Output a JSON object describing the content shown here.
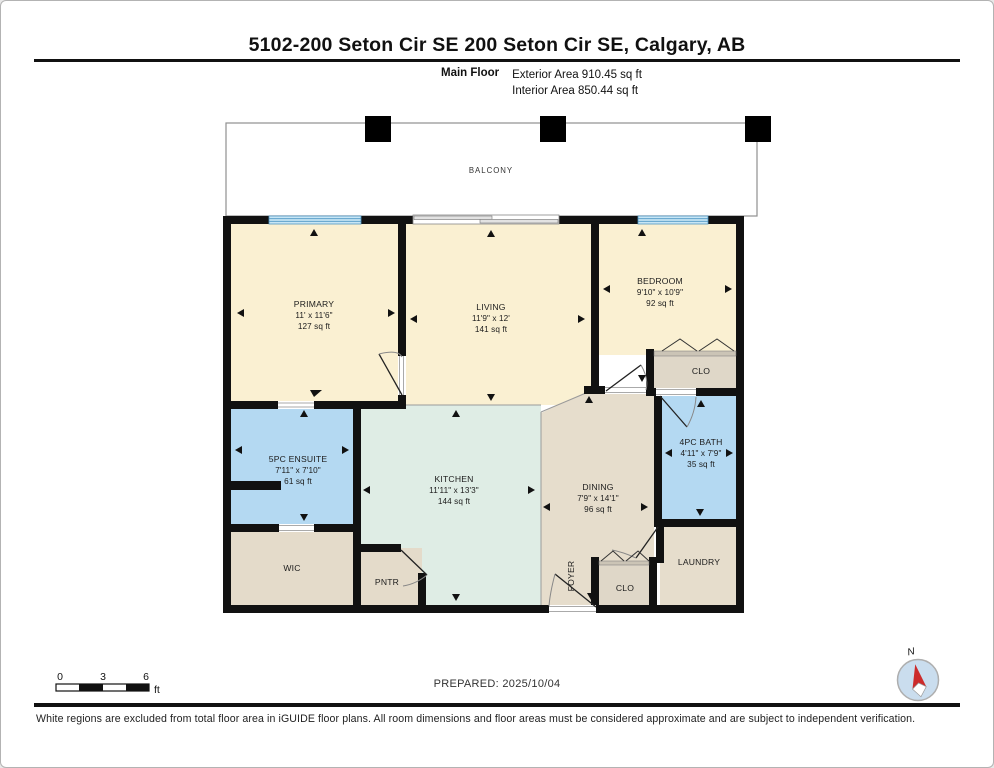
{
  "header": {
    "title": "5102-200 Seton Cir SE 200 Seton Cir SE, Calgary, AB",
    "floor_label": "Main Floor",
    "exterior_area": "Exterior Area 910.45 sq ft",
    "interior_area": "Interior Area 850.44 sq ft"
  },
  "rooms": {
    "balcony": {
      "name": "BALCONY"
    },
    "primary": {
      "name": "PRIMARY",
      "dims": "11' x 11'6\"",
      "area": "127 sq ft"
    },
    "living": {
      "name": "LIVING",
      "dims": "11'9\" x 12'",
      "area": "141 sq ft"
    },
    "bedroom": {
      "name": "BEDROOM",
      "dims": "9'10\" x 10'9\"",
      "area": "92 sq ft"
    },
    "ensuite": {
      "name": "5PC ENSUITE",
      "dims": "7'11\" x 7'10\"",
      "area": "61 sq ft"
    },
    "kitchen": {
      "name": "KITCHEN",
      "dims": "11'11\" x 13'3\"",
      "area": "144 sq ft"
    },
    "dining": {
      "name": "DINING",
      "dims": "7'9\" x 14'1\"",
      "area": "96 sq ft"
    },
    "bath": {
      "name": "4PC BATH",
      "dims": "4'11\" x 7'9\"",
      "area": "35 sq ft"
    },
    "wic": {
      "name": "WIC"
    },
    "pantry": {
      "name": "PNTR"
    },
    "foyer": {
      "name": "FOYER"
    },
    "closet_bedroom": {
      "name": "CLO"
    },
    "closet_foyer": {
      "name": "CLO"
    },
    "laundry": {
      "name": "LAUNDRY"
    }
  },
  "scale_bar": {
    "ticks": [
      "0",
      "3",
      "6"
    ],
    "unit": "ft"
  },
  "compass": {
    "label": "N"
  },
  "footer": {
    "prepared": "PREPARED: 2025/10/04",
    "disclaimer": "White regions are excluded from total floor area in iGUIDE floor plans. All room dimensions and floor areas must be considered approximate and are subject to independent verification."
  },
  "colors": {
    "room_cream": "#FAF0D2",
    "room_blue": "#B4D9F2",
    "room_tan": "#E6DDCC",
    "room_mint": "#DFEDE5",
    "closet_tan": "#DFD7C8",
    "wall_black": "#111111",
    "window_blue": "#4E96C4",
    "compass_red": "#CC2B2B"
  }
}
